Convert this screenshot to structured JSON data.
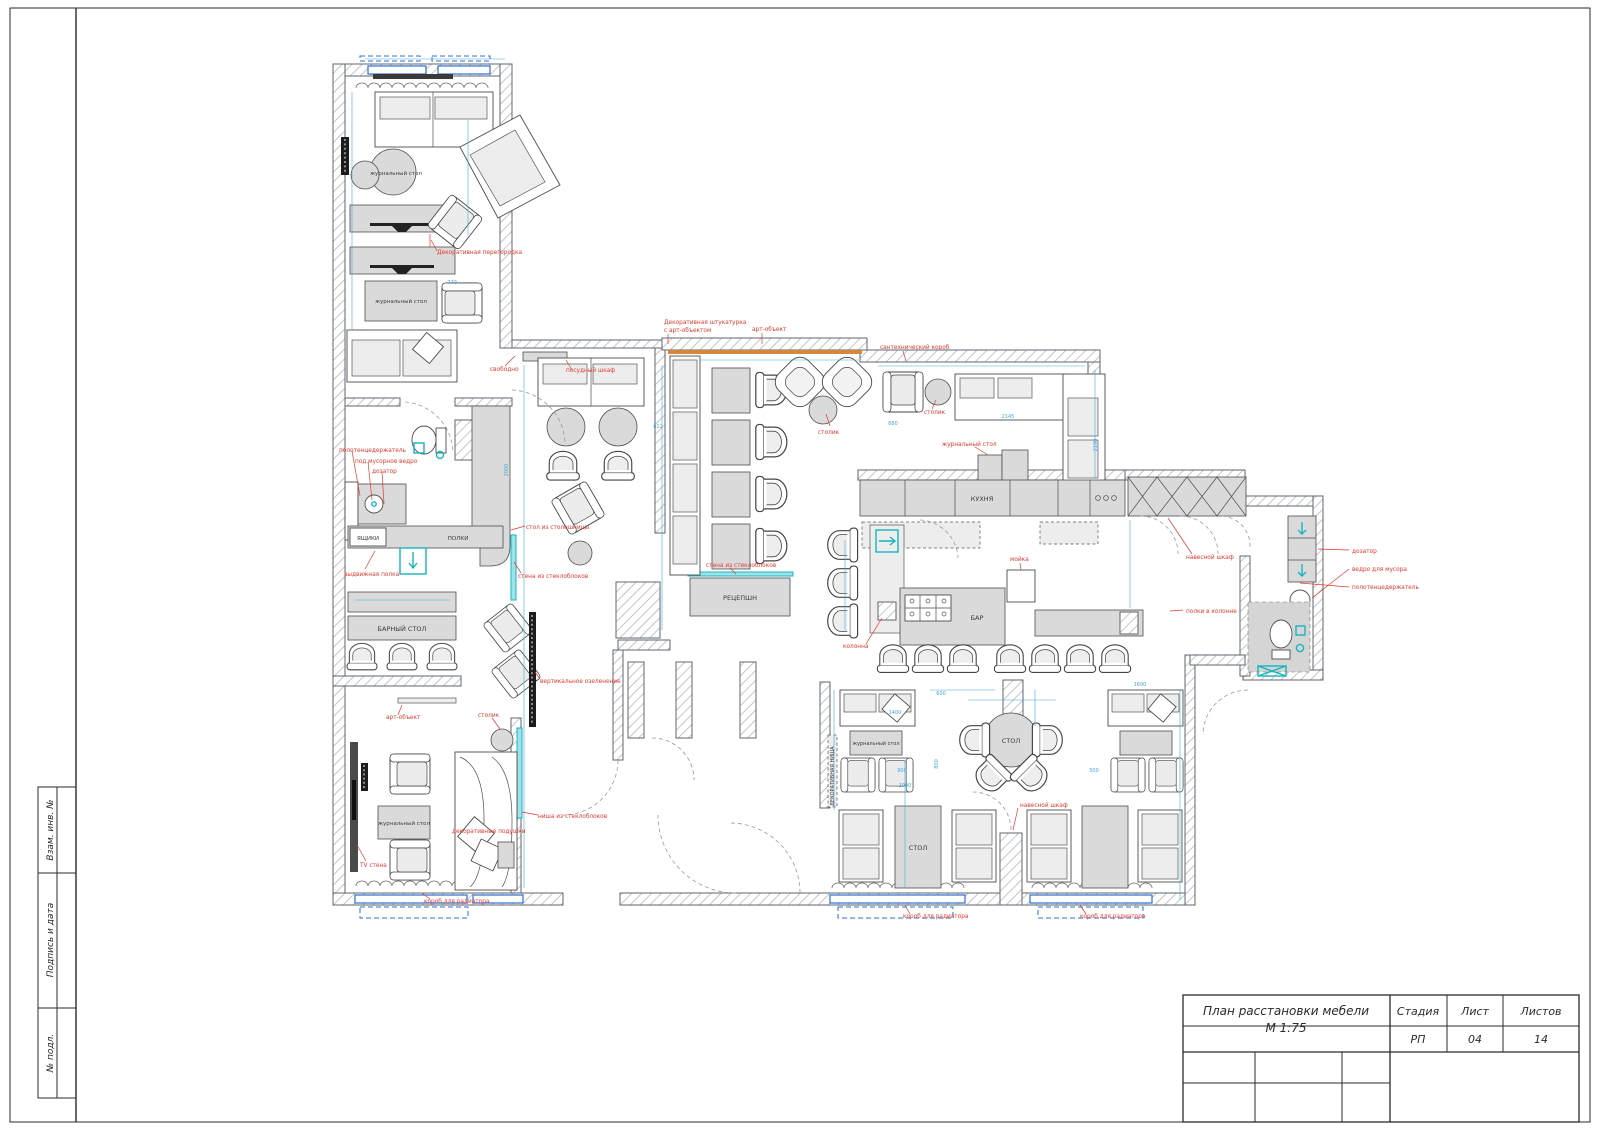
{
  "title_block": {
    "title_line1": "План расстановки мебели",
    "title_line2": "М 1:75",
    "col1_header": "Стадия",
    "col2_header": "Лист",
    "col3_header": "Листов",
    "col1_value": "РП",
    "col2_value": "04",
    "col3_value": "14"
  },
  "frame": {
    "stamp_rows": [
      {
        "label": "Взам. инв. №"
      },
      {
        "label": "Подпись и дата"
      },
      {
        "label": "№ подл."
      }
    ]
  },
  "colors": {
    "annotation_red": "#e03a31",
    "dimension_blue": "#45a8de",
    "window_blue": "#2b6fd4",
    "glassblock_teal": "#18b4bf",
    "banquette_orange": "#d6873b",
    "furniture_gray": "#dadada"
  },
  "labels": [
    {
      "text": "журнальный стол"
    },
    {
      "text": "журнальный стол"
    },
    {
      "text": "ЯЩИКИ"
    },
    {
      "text": "ПОЛКИ"
    },
    {
      "text": "БАРНЫЙ СТОЛ"
    },
    {
      "text": "журнальный стол"
    },
    {
      "text": "РЕЦЕПШН"
    },
    {
      "text": "КУХНЯ"
    },
    {
      "text": "БАР"
    },
    {
      "text": "СТОЛ"
    },
    {
      "text": "СТОЛ"
    },
    {
      "text": "журнальный стол"
    },
    {
      "text": "ДЕКОРАТИВНАЯ НИША"
    },
    {
      "text": "Декоративная перегородка"
    },
    {
      "text": "полотенцедержатель"
    },
    {
      "text": "под мусорное ведро"
    },
    {
      "text": "дозатор"
    },
    {
      "text": "выдвижная полка"
    },
    {
      "text": "свободно"
    },
    {
      "text": "посудный шкаф"
    },
    {
      "text": "Декоративная штукатурка"
    },
    {
      "text": "с арт-объектом"
    },
    {
      "text": "арт-объект"
    },
    {
      "text": "столик"
    },
    {
      "text": "стена из стеклоблоков"
    },
    {
      "text": "стена из стеклоблоков"
    },
    {
      "text": "сантехнический короб"
    },
    {
      "text": "столик"
    },
    {
      "text": "журнальный стол"
    },
    {
      "text": "мойка"
    },
    {
      "text": "колонна"
    },
    {
      "text": "навесной шкаф"
    },
    {
      "text": "полки в колонне"
    },
    {
      "text": "дозатор"
    },
    {
      "text": "ведро для мусора"
    },
    {
      "text": "полотенцедержатель"
    },
    {
      "text": "навесной шкаф"
    },
    {
      "text": "короб для радиатора"
    },
    {
      "text": "короб для радиатора"
    },
    {
      "text": "короб для радиатора"
    },
    {
      "text": "арт-объект"
    },
    {
      "text": "столик"
    },
    {
      "text": "ТV стена"
    },
    {
      "text": "декоративные подушки"
    },
    {
      "text": "ниша из стеклоблоков"
    },
    {
      "text": "вертикальное озеленение"
    },
    {
      "text": "стол из столешницы"
    }
  ],
  "dims": [
    {
      "text": "2145"
    },
    {
      "text": "2190"
    },
    {
      "text": "680"
    },
    {
      "text": "770"
    },
    {
      "text": "1400"
    },
    {
      "text": "600"
    },
    {
      "text": "612"
    },
    {
      "text": "2000"
    },
    {
      "text": "900"
    },
    {
      "text": "500"
    },
    {
      "text": "800"
    },
    {
      "text": "1600"
    },
    {
      "text": "1000"
    }
  ]
}
